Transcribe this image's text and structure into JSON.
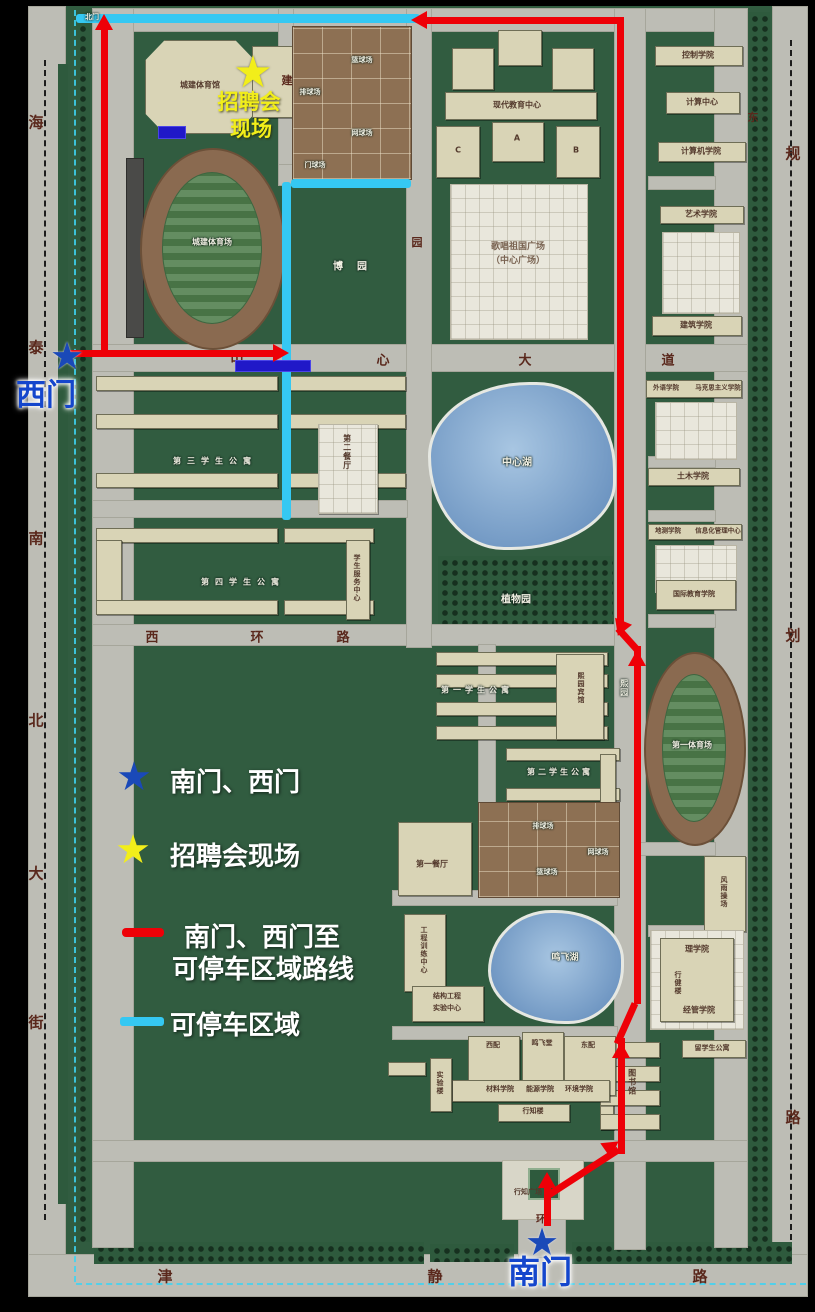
{
  "legend": {
    "gates_label": "南门、西门",
    "fair_label": "招聘会现场",
    "route_label_line1": "南门、西门至",
    "route_label_line2": "可停车区域路线",
    "parking_label": "可停车区域"
  },
  "gates": {
    "west": "西门",
    "south": "南门",
    "north": "北门"
  },
  "fair": {
    "line1": "招聘会",
    "line2": "现场"
  },
  "streets": {
    "west_avenue": [
      "海",
      "泰",
      "南",
      "北",
      "大",
      "街"
    ],
    "east_avenue": [
      "规",
      "划",
      "路"
    ],
    "south_avenue": [
      "津",
      "静",
      "路"
    ],
    "central_avenue": [
      "中",
      "心",
      "大",
      "道"
    ],
    "west_ring": [
      "西",
      "环",
      "路"
    ],
    "misc": {
      "yuan": "园",
      "jian": "建",
      "dong": "东",
      "huan": "环"
    }
  },
  "places": {
    "gym": "城建体育馆",
    "stadium": "城建体育场",
    "basketball": "篮球场",
    "volleyball": "排球场",
    "tennis": "网球场",
    "gateball": "门球场",
    "modern_edu": "现代教育中心",
    "block_a": "A",
    "block_b": "B",
    "block_c": "C",
    "plaza_line1": "歌唱祖国广场",
    "plaza_line2": "（中心广场）",
    "boyuan": "博园",
    "central_lake": "中心湖",
    "botanic": "植物园",
    "dorm3": "第三学生公寓",
    "dorm4": "第四学生公寓",
    "service_center": "学生服务中心",
    "canteen2": "第二餐厅",
    "control": "控制学院",
    "computing_center": "计算中心",
    "computer": "计算机学院",
    "art": "艺术学院",
    "architecture": "建筑学院",
    "foreign": "外语学院",
    "marxism": "马克思主义学院",
    "civil": "土木学院",
    "geomatics": "地测学院",
    "info_center": "信息化管理中心",
    "intl_edu": "国际教育学院",
    "stadium1": "第一体育场",
    "playground": "风雨操场",
    "dorm1": "第一学生公寓",
    "dorm2": "第二学生公寓",
    "xiyuan_hotel": "熙园宾馆",
    "xiyuan": "熙园",
    "canteen1": "第一餐厅",
    "volleyball2": "排球场",
    "tennis2": "网球场",
    "basketball2": "篮球场",
    "training_center": "工程训练中心",
    "structure_lab_line1": "结构工程",
    "structure_lab_line2": "实验中心",
    "mingfei_lake": "鸣飞湖",
    "west_annex": "西配",
    "mingfei_hall": "鸣飞堂",
    "east_annex": "东配",
    "materials": "材料学院",
    "energy": "能源学院",
    "environment": "环境学院",
    "xingzhi_bldg": "行知楼",
    "lab_bldg": "实验楼",
    "science": "理学院",
    "xingjian_bldg": "行健楼",
    "management": "经管学院",
    "intl_dorm": "留学生公寓",
    "library": "图书馆",
    "xingzhi_plaza": "行知广场"
  }
}
